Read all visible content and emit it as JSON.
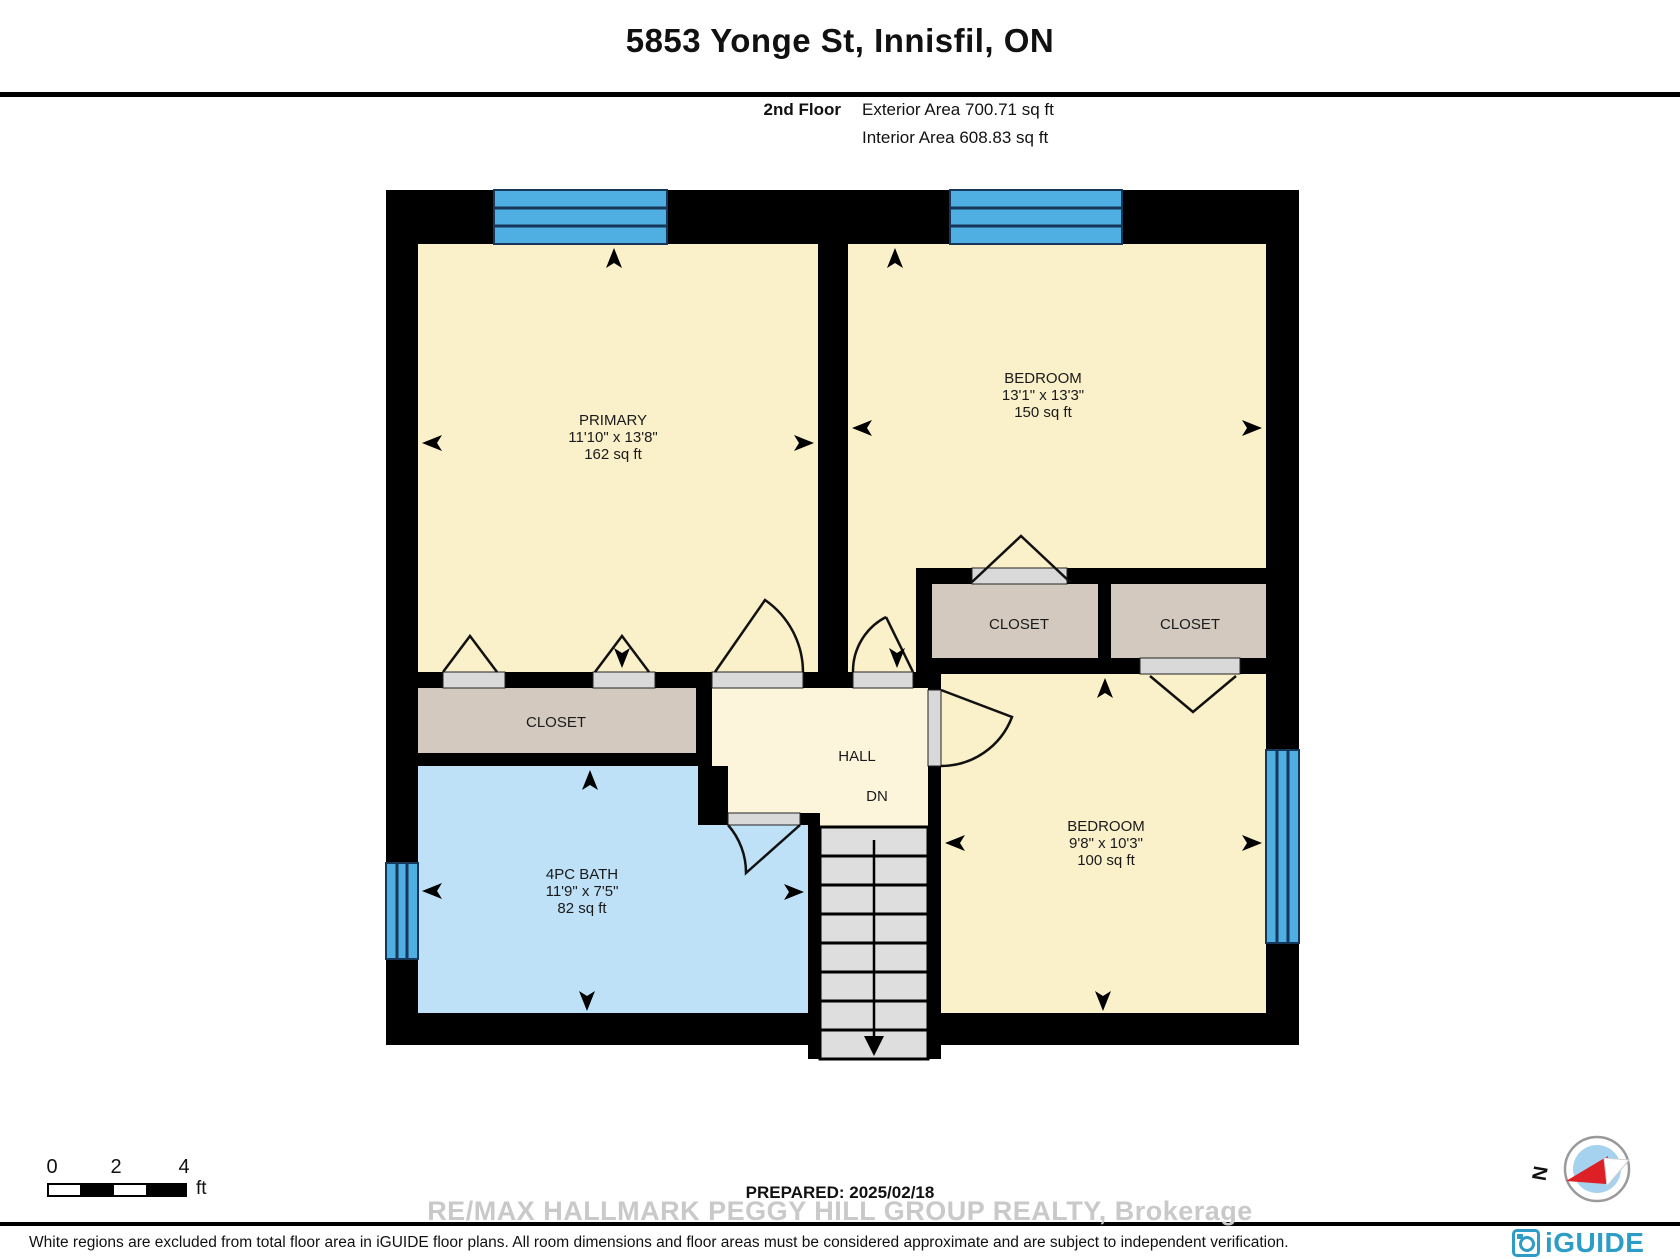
{
  "header": {
    "title": "5853 Yonge St, Innisfil, ON",
    "floor_label": "2nd Floor",
    "exterior_area": "Exterior Area 700.71 sq ft",
    "interior_area": "Interior Area 608.83 sq ft"
  },
  "rooms": {
    "primary": {
      "name": "PRIMARY",
      "dimensions": "11'10\" x 13'8\"",
      "area": "162 sq ft"
    },
    "bedroom_top": {
      "name": "BEDROOM",
      "dimensions": "13'1\" x 13'3\"",
      "area": "150 sq ft"
    },
    "bedroom_bottom": {
      "name": "BEDROOM",
      "dimensions": "9'8\" x 10'3\"",
      "area": "100 sq ft"
    },
    "bath": {
      "name": "4PC BATH",
      "dimensions": "11'9\" x 7'5\"",
      "area": "82 sq ft"
    },
    "closet_primary": {
      "name": "CLOSET"
    },
    "closet_right_1": {
      "name": "CLOSET"
    },
    "closet_right_2": {
      "name": "CLOSET"
    },
    "hall": {
      "name": "HALL",
      "stair_label": "DN"
    }
  },
  "scale_bar": {
    "tick_0": "0",
    "tick_2": "2",
    "tick_4": "4",
    "unit": "ft"
  },
  "compass": {
    "north_label": "N"
  },
  "footer": {
    "prepared": "PREPARED: 2025/02/18",
    "watermark": "RE/MAX HALLMARK PEGGY HILL GROUP REALTY, Brokerage",
    "disclaimer": "White regions are excluded from total floor area in iGUIDE floor plans. All room dimensions and floor areas must be considered approximate and are subject to independent verification.",
    "brand": "iGUIDE"
  },
  "colors": {
    "room_fill": "#FAF0C9",
    "hall_fill": "#FCF5DC",
    "closet_fill": "#D3C9BE",
    "bath_fill": "#BEE1F7",
    "window_blue": "#4FAEE2",
    "wall_black": "#000000",
    "threshold_gray": "#D9D9D9",
    "stair_gray": "#DEDEDE",
    "brand_blue": "#2D9DC8",
    "compass_red": "#DD1F26",
    "watermark_gray": "#C9C9C9"
  }
}
